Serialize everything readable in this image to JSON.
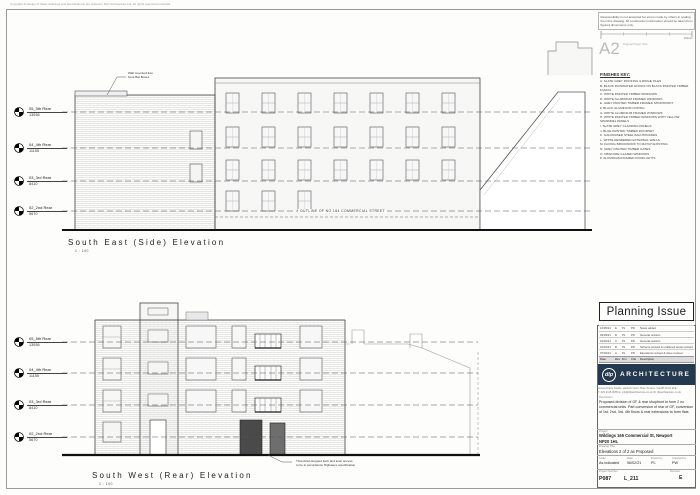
{
  "page": {
    "copyright": "Copyright & Design of these drawings and specifications are vested in DLP Architecture Ltd. All rights reserved protected.",
    "disclaimer": "Responsibility is not accepted for errors made by others in scaling from this drawing. All construction information should be taken from figured dimensions only.",
    "scale_bar_zero": "0",
    "scale_bar_end": "100mm",
    "paper_size": "A2",
    "paper_caption": "Original Paper Size"
  },
  "finishes_key": {
    "title": "FINISHES KEY:",
    "items": [
      "A.  SLATE GREY ROOFING & RIDGE TILES",
      "B.  BLACK RAINWATER GOODS ON BLACK PAINTED TIMBER FASCIA",
      "C.  WHITE PAINTED TIMBER WINDOWS",
      "D.  WHITE ALUMINIUM FRAMED WINDOWS",
      "E.  GREY PAINTED TIMBER FRAMED SHOPFRONT",
      "F.  BLACK ALUMINIUM COPING",
      "G.  WHITE ALUMINIUM FRAMED WINDOWS",
      "H.  WHITE PAINTED TIMBER WINDOWS WITH YELLOW SPANDREL PANELS",
      "I.  SLATE GREY CLADDING PANELS",
      "J.  BLUE PAINTED TIMBER DOORSET",
      "K.  GALVANISED STEEL BALUSTRADES",
      "L.  WHITE RENDERED EXTERNAL WALLS",
      "M.  FACING BRICKWORK TO MATCH EXISTING",
      "N.  GREY PAINTED TIMBER GATES",
      "O.  OBSCURE GLAZED WINDOWS",
      "P.  ALUMINIUM FRAMED ROOFLIGHTS"
    ]
  },
  "levels": [
    {
      "label": "05_5th Rear",
      "value": "13936"
    },
    {
      "label": "04_4th Rear",
      "value": "11155"
    },
    {
      "label": "03_3rd Rear",
      "value": "8410"
    },
    {
      "label": "02_2nd Rear",
      "value": "5670"
    }
  ],
  "elevation_side": {
    "title": "South East (Side) Elevation",
    "scale": "1 : 100",
    "bat_note_line1": "Wall mounted Eco",
    "bat_note_line2": "Kent Bat Boxes",
    "outline_note": "OUTLINE OF NO 164 COMMERCIAL STREET"
  },
  "elevation_rear": {
    "title": "South West (Rear) Elevation",
    "scale": "1 : 100",
    "threshold_note_line1": "Threshold dropped kerb and level access",
    "threshold_note_line2": "to be in accordance Highways specification"
  },
  "title_block": {
    "status": "Planning Issue",
    "revisions": [
      {
        "date": "12/05/21",
        "rev": "E",
        "drn": "PL",
        "chk": "PD",
        "desc": "Notes added"
      },
      {
        "date": "03/03/21",
        "rev": "D",
        "drn": "PL",
        "chk": "PD",
        "desc": "General revision"
      },
      {
        "date": "19/02/21",
        "rev": "C",
        "drn": "PL",
        "chk": "PD",
        "desc": "General revision"
      },
      {
        "date": "10/02/21",
        "rev": "B",
        "drn": "PL",
        "chk": "PD",
        "desc": "Scheme revised & unaltered areas revised"
      },
      {
        "date": "07/02/21",
        "rev": "A",
        "drn": "PL",
        "chk": "PD",
        "desc": "Elevations revised & issue revised"
      }
    ],
    "rev_headers": {
      "date": "Date",
      "rev": "Rev",
      "drn": "Drn",
      "chk": "Chk",
      "desc": "Description"
    },
    "logo_initials": "dlp",
    "logo_name": "ARCHITECTURE",
    "address_line1": "Ground Floor Studio, Harlech Court, Bute Terrace, Cardiff CF10 2FE",
    "address_line2": "T. 029 2115 0085   E. info@dlparchitecture.co.uk   W. dlparchitecture.co.uk",
    "description_label": "Description",
    "description": "Proposed division of GF & rear shopfront to form 2 no commercial units. Part conversion of rear of GF, conversion of 1st, 2nd, 3rd, 4th floors & rear extensions to form flats",
    "project_label": "Project",
    "project": "Wildings 165 Commercial St, Newport",
    "project_postcode": "NP20 1HL",
    "drawing_title_label": "Drawing Title",
    "drawing_title": "Elevations 2 of 2 as Proposed",
    "scale_label": "Scale",
    "scale_value": "As indicated",
    "date_label": "Date",
    "date_value": "06/02/21",
    "drawn_label": "Drawn by",
    "drawn_value": "PL",
    "checked_label": "Checked by",
    "checked_value": "PW",
    "project_number_label": "Project Number",
    "project_number": "P087",
    "drawing_number": "L_211",
    "revision_label": "Revision",
    "revision_value": "E"
  },
  "colors": {
    "logo_navy": "#24384f",
    "line_dark": "#222222",
    "hatch_grey": "#d6d6d6"
  }
}
